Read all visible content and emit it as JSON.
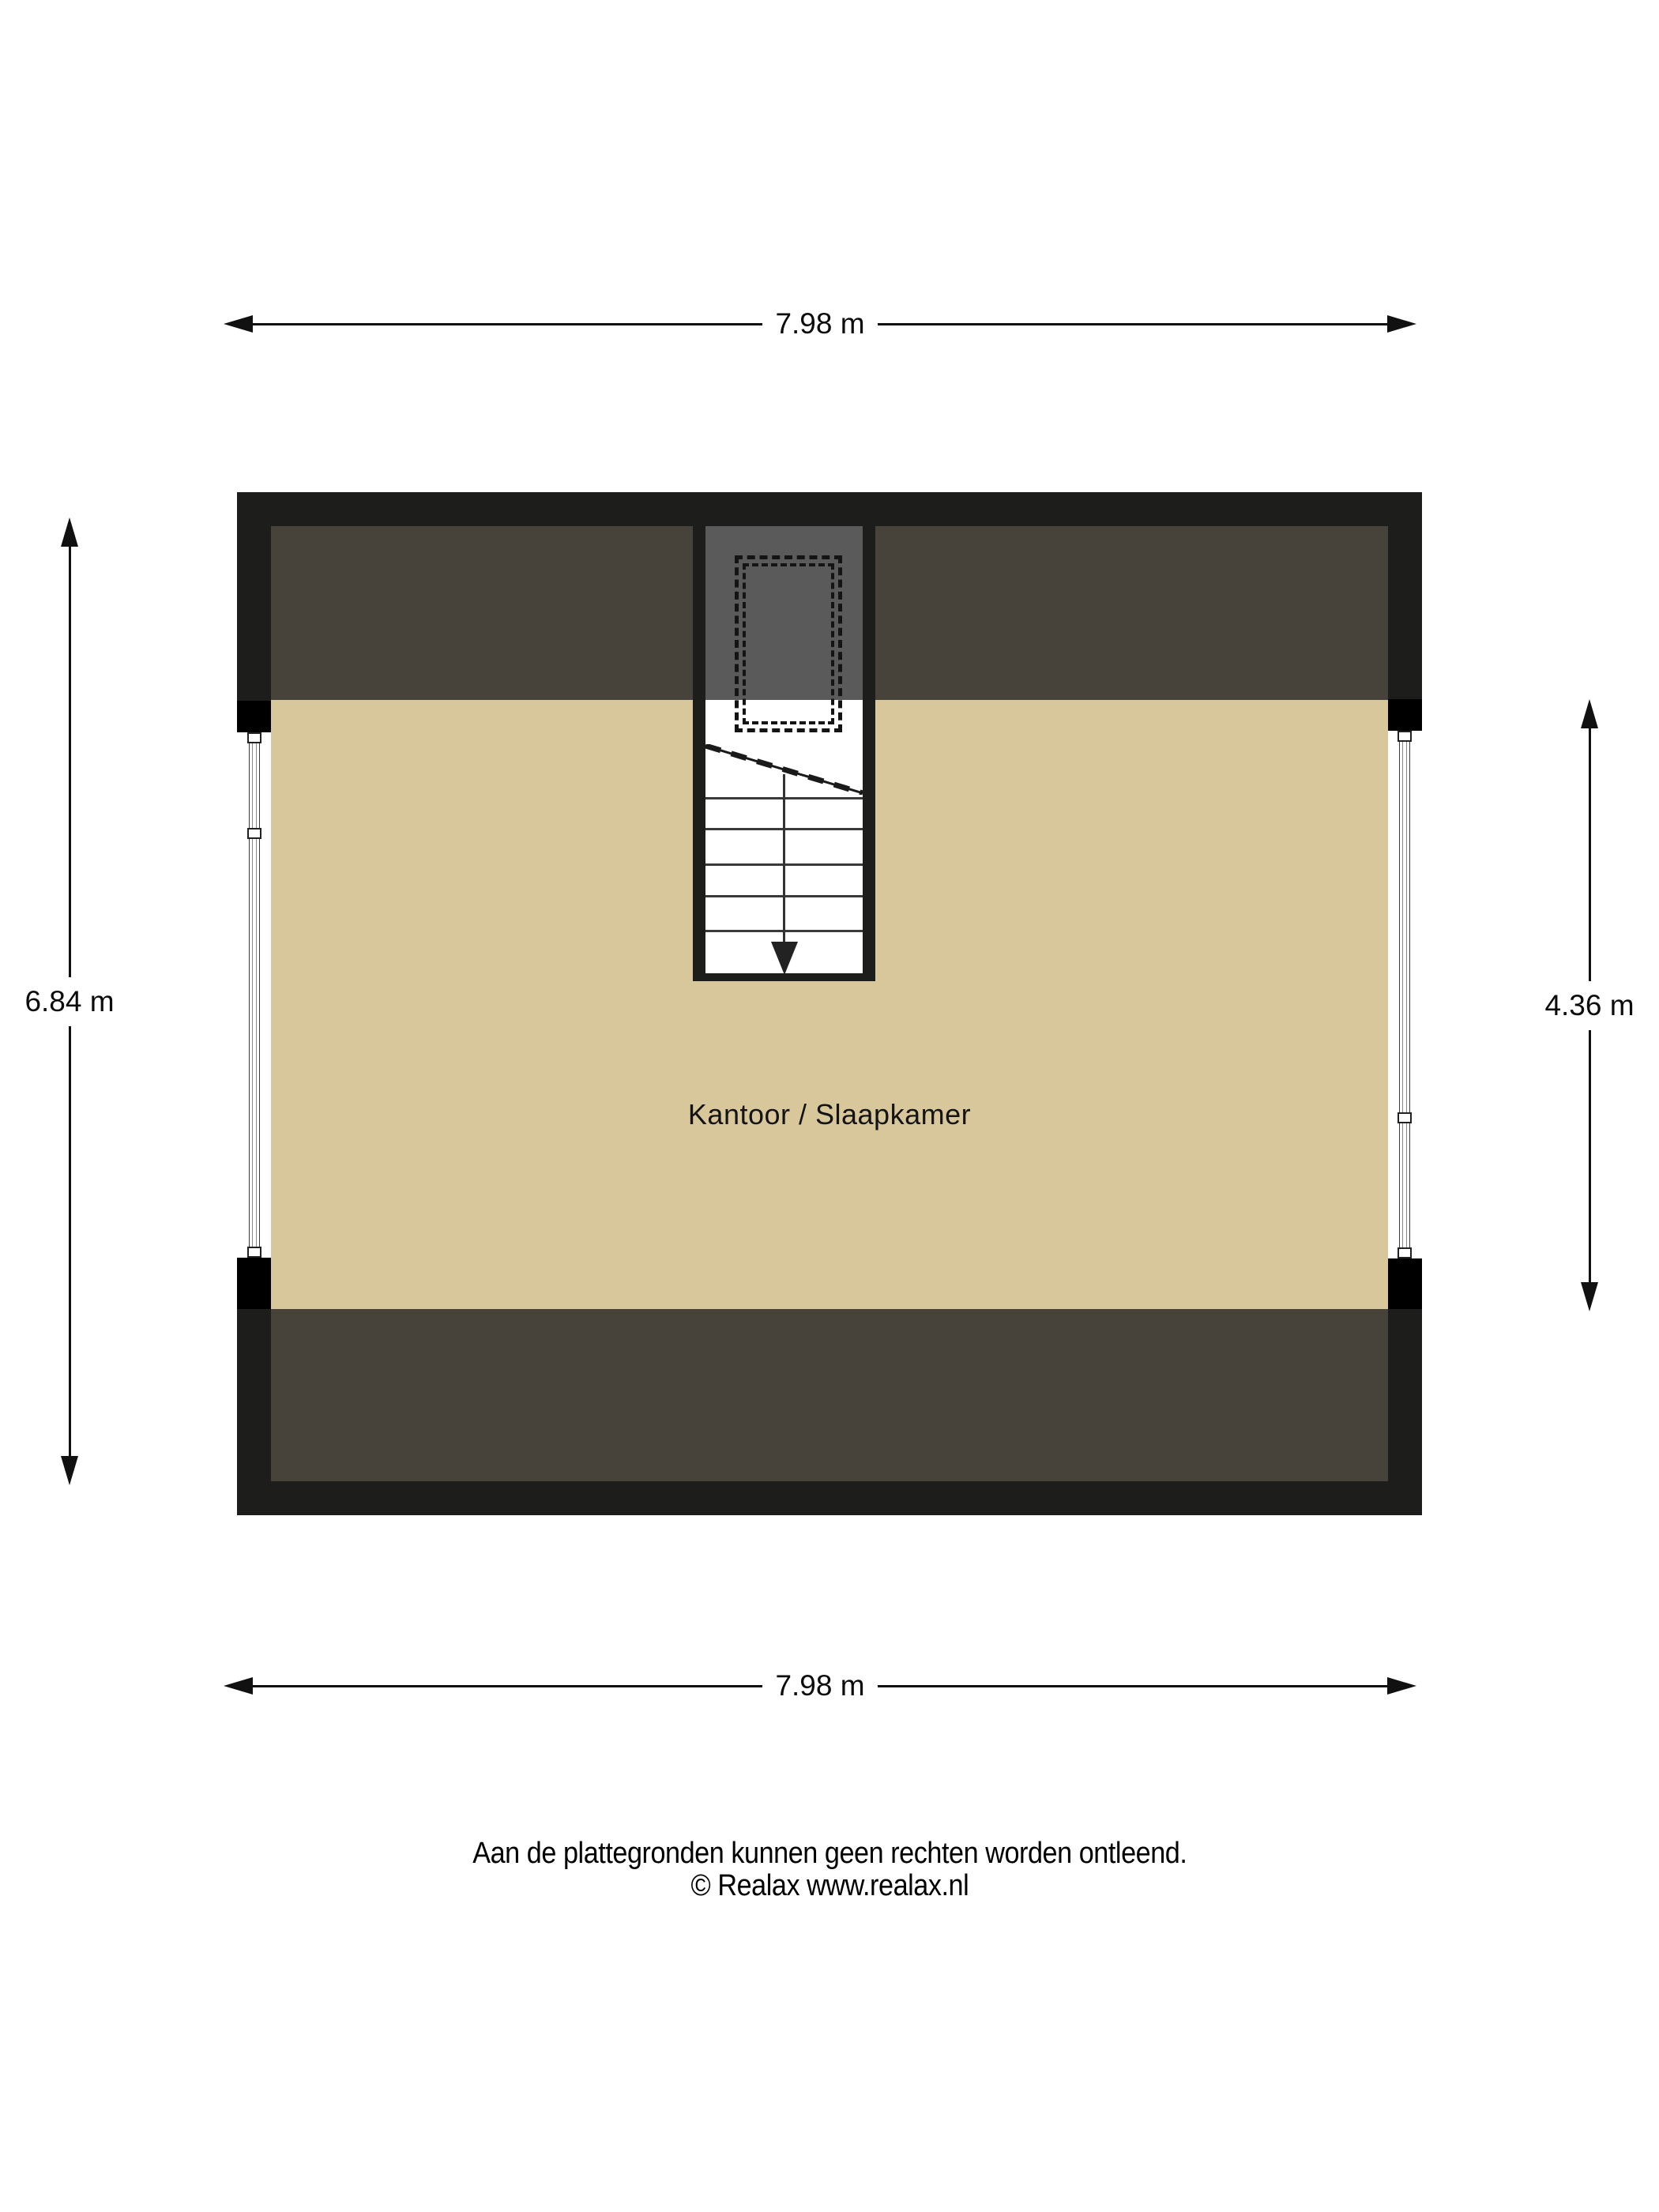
{
  "floorplan": {
    "room_label": "Kantoor / Slaapkamer",
    "dimensions": {
      "top": "7.98 m",
      "bottom": "7.98 m",
      "left": "6.84 m",
      "right": "4.36 m"
    },
    "stairs": {
      "direction": "down",
      "steps": 5
    },
    "colors": {
      "page-bg": "#ffffff",
      "wall": "#1d1d1b",
      "wall-block": "#000000",
      "attic": "#48433a",
      "floor": "#d7c79a",
      "stair-gray": "#5a5a5a",
      "line": "#111111"
    }
  },
  "footer": {
    "disclaimer": "Aan de plattegronden kunnen geen rechten worden ontleend.",
    "copyright": "© Realax www.realax.nl"
  }
}
